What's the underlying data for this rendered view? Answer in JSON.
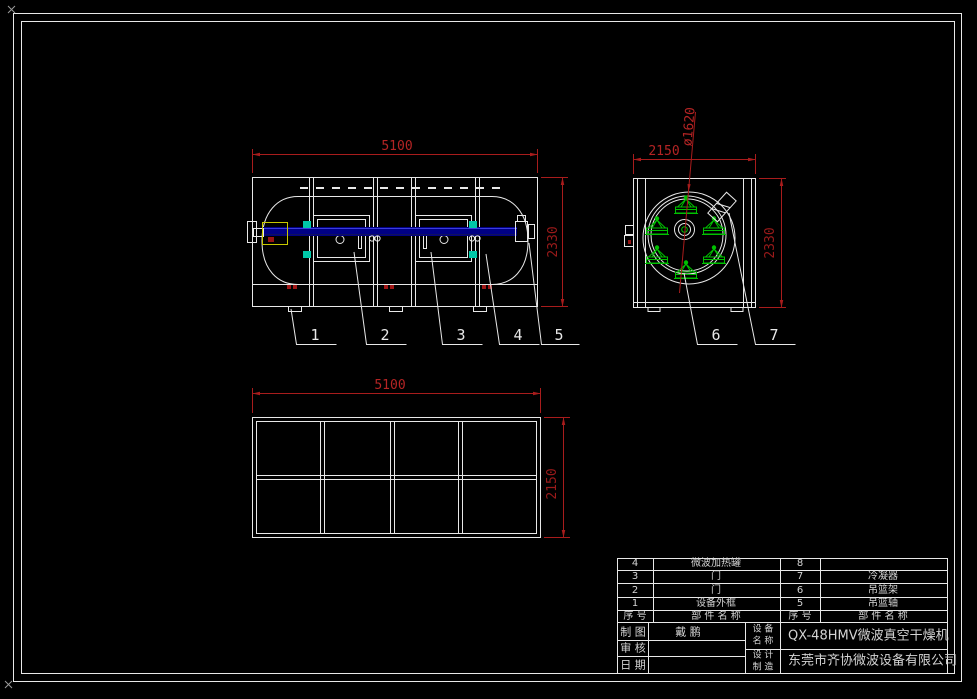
{
  "app": {
    "type": "cad-drawing-viewport",
    "background": "#000000"
  },
  "colors": {
    "line": "#e8e8e8",
    "dimension_text": "#b42424",
    "dimension_line": "#a81c1c",
    "shaft_blue": "#000090",
    "basket_green": "#00c000",
    "bracket_cyan": "#00c8a8",
    "highlight_yellow": "#c8c800",
    "roller_red": "#a01616"
  },
  "views": {
    "front": {
      "dim_width": "5100",
      "dim_height": "2330"
    },
    "end": {
      "dim_width": "2150",
      "dim_height": "2330",
      "dim_diameter": "ø1620"
    },
    "top": {
      "dim_width": "5100",
      "dim_depth": "2150"
    }
  },
  "callouts": [
    "1",
    "2",
    "3",
    "4",
    "5",
    "6",
    "7"
  ],
  "title_block": {
    "parts": [
      {
        "no": "4",
        "name": "微波加热罐",
        "no2": "8",
        "name2": ""
      },
      {
        "no": "3",
        "name": "门",
        "no2": "7",
        "name2": "冷凝器"
      },
      {
        "no": "2",
        "name": "门",
        "no2": "6",
        "name2": "吊篮架"
      },
      {
        "no": "1",
        "name": "设备外框",
        "no2": "5",
        "name2": "吊篮轴"
      }
    ],
    "header": {
      "no": "序 号",
      "name": "部 件 名 称",
      "no2": "序 号",
      "name2": "部 件 名 称"
    },
    "drawn_label": "制 图",
    "drawn_value": "戴  鹏",
    "check_label": "审 核",
    "check_value": "",
    "date_label": "日 期",
    "date_value": "",
    "device_label_top": "设 备",
    "device_label_bottom": "名 称",
    "device_name": "QX-48HMV微波真空干燥机",
    "maker_label_top": "设 计",
    "maker_label_bottom": "制 造",
    "company": "东莞市齐协微波设备有限公司"
  }
}
